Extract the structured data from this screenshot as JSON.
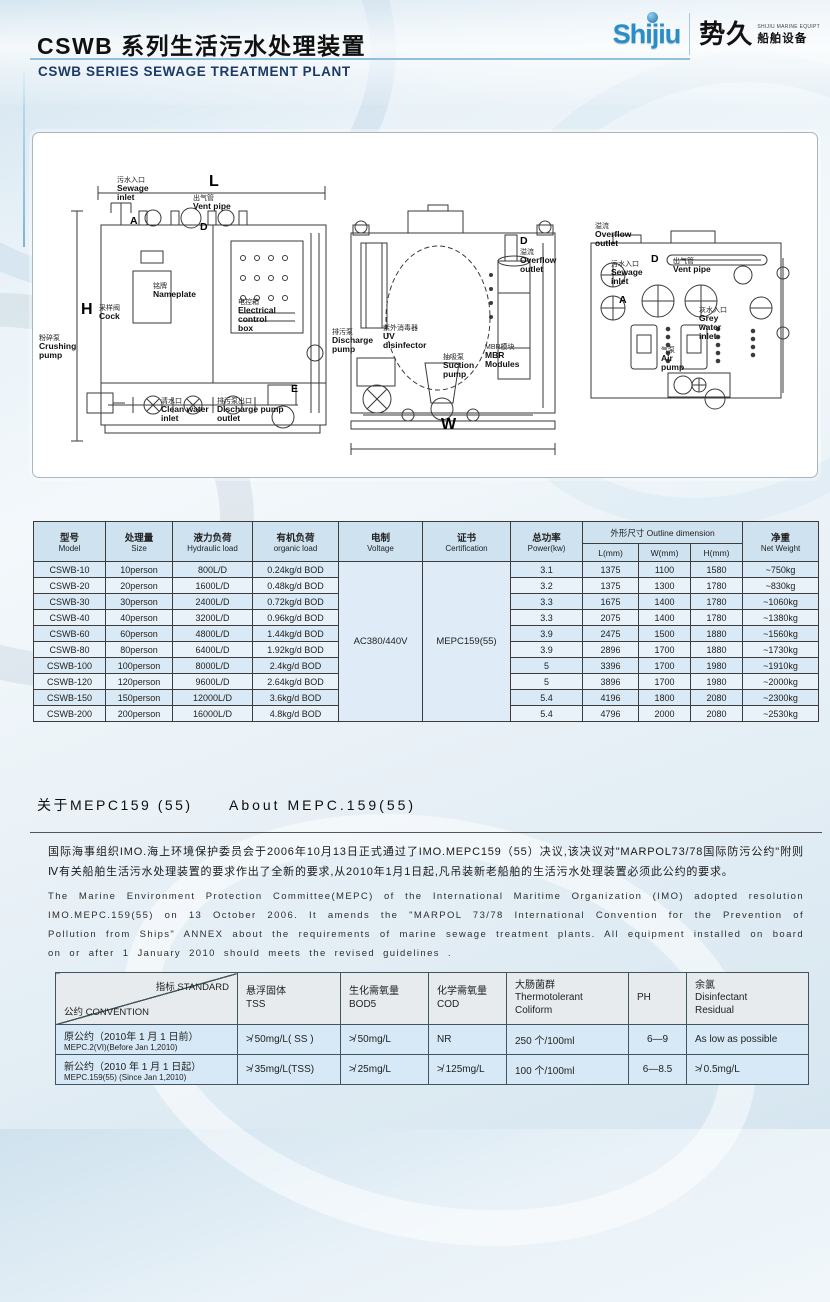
{
  "colors": {
    "brand_blue": "#2b8dc8",
    "title_navy": "#1d3a66",
    "table_header_blue": "#cfe2f0",
    "table_row_blue": "#d9e9f5",
    "table_row_light": "#e9f2f9",
    "std_header_gray": "#e7ebee",
    "std_row_blue": "#d7e9f6"
  },
  "header": {
    "title_cn": "CSWB 系列生活污水处理装置",
    "title_en": "CSWB SERIES  SEWAGE TREATMENT PLANT",
    "logo": {
      "brand": "Shijiu",
      "name_cn": "势久",
      "tagline": "SHIJIU MARINE EQUIPT",
      "sub_cn": "船舶设备"
    }
  },
  "diagram": {
    "labels": {
      "sewage_inlet": {
        "cn": "污水入口",
        "en": "Sewage\ninlet"
      },
      "vent_pipe": {
        "cn": "出气管",
        "en": "Vent  pipe"
      },
      "nameplate": {
        "cn": "铭牌",
        "en": "Nameplate"
      },
      "electrical_box": {
        "cn": "电控箱",
        "en": "Electrical\ncontrol\nbox"
      },
      "cock": {
        "cn": "采样阀",
        "en": "Cock"
      },
      "crushing_pump": {
        "cn": "粉碎泵",
        "en": "Crushing\npump"
      },
      "clean_water_inlet": {
        "cn": "清水口",
        "en": "Clean water\ninlet"
      },
      "discharge_pump_outlet": {
        "cn": "排污泵出口",
        "en": "Discharge pump\noutlet"
      },
      "overflow_outlet_side": {
        "cn": "溢流",
        "en": "Overflow\noutlet"
      },
      "discharge_pump": {
        "cn": "排污泵",
        "en": "Discharge\npump"
      },
      "uv_disinfector": {
        "cn": "紫外消毒器",
        "en": "UV\ndisinfector"
      },
      "suction_pump": {
        "cn": "抽吸泵",
        "en": "Suction\npump"
      },
      "mbr_modules": {
        "cn": "MBR模块",
        "en": "MBR\nModules"
      },
      "overflow_outlet_top": {
        "cn": "溢流",
        "en": "Overflow\noutlet"
      },
      "sewage_inlet_top": {
        "cn": "污水入口",
        "en": "Sewage\ninlet"
      },
      "vent_pipe_top": {
        "cn": "出气管",
        "en": "Vent  pipe"
      },
      "grey_water_inlet": {
        "cn": "灰水入口",
        "en": "Grey\nwater\ninlet"
      },
      "air_pump": {
        "cn": "气泵",
        "en": "Air\npump"
      }
    },
    "markers": {
      "l": "L",
      "h": "H",
      "w": "W",
      "a": "A",
      "d": "D",
      "e": "E"
    }
  },
  "spec_table": {
    "headers": {
      "model_cn": "型号",
      "model_en": "Model",
      "size_cn": "处理量",
      "size_en": "Size",
      "hydraulic_cn": "液力负荷",
      "hydraulic_en": "Hydraulic load",
      "organic_cn": "有机负荷",
      "organic_en": "organic load",
      "voltage_cn": "电制",
      "voltage_en": "Voltage",
      "cert_cn": "证书",
      "cert_en": "Certification",
      "power_cn": "总功率",
      "power_en": "Power(kw)",
      "outline": "外形尺寸  Outline dimension",
      "l": "L(mm)",
      "w": "W(mm)",
      "h": "H(mm)",
      "weight_cn": "净重",
      "weight_en": "Net Weight"
    },
    "voltage": "AC380/440V",
    "certification": "MEPC159(55)",
    "rows": [
      {
        "model": "CSWB-10",
        "size": "10person",
        "hydraulic": "800L/D",
        "organic": "0.24kg/d BOD",
        "power": "3.1",
        "l": "1375",
        "w": "1100",
        "h": "1580",
        "weight": "~750kg"
      },
      {
        "model": "CSWB-20",
        "size": "20person",
        "hydraulic": "1600L/D",
        "organic": "0.48kg/d BOD",
        "power": "3.2",
        "l": "1375",
        "w": "1300",
        "h": "1780",
        "weight": "~830kg"
      },
      {
        "model": "CSWB-30",
        "size": "30person",
        "hydraulic": "2400L/D",
        "organic": "0.72kg/d BOD",
        "power": "3.3",
        "l": "1675",
        "w": "1400",
        "h": "1780",
        "weight": "~1060kg"
      },
      {
        "model": "CSWB-40",
        "size": "40person",
        "hydraulic": "3200L/D",
        "organic": "0.96kg/d BOD",
        "power": "3.3",
        "l": "2075",
        "w": "1400",
        "h": "1780",
        "weight": "~1380kg"
      },
      {
        "model": "CSWB-60",
        "size": "60person",
        "hydraulic": "4800L/D",
        "organic": "1.44kg/d BOD",
        "power": "3.9",
        "l": "2475",
        "w": "1500",
        "h": "1880",
        "weight": "~1560kg"
      },
      {
        "model": "CSWB-80",
        "size": "80person",
        "hydraulic": "6400L/D",
        "organic": "1.92kg/d BOD",
        "power": "3.9",
        "l": "2896",
        "w": "1700",
        "h": "1880",
        "weight": "~1730kg"
      },
      {
        "model": "CSWB-100",
        "size": "100person",
        "hydraulic": "8000L/D",
        "organic": "2.4kg/d BOD",
        "power": "5",
        "l": "3396",
        "w": "1700",
        "h": "1980",
        "weight": "~1910kg"
      },
      {
        "model": "CSWB-120",
        "size": "120person",
        "hydraulic": "9600L/D",
        "organic": "2.64kg/d BOD",
        "power": "5",
        "l": "3896",
        "w": "1700",
        "h": "1980",
        "weight": "~2000kg"
      },
      {
        "model": "CSWB-150",
        "size": "150person",
        "hydraulic": "12000L/D",
        "organic": "3.6kg/d BOD",
        "power": "5.4",
        "l": "4196",
        "w": "1800",
        "h": "2080",
        "weight": "~2300kg"
      },
      {
        "model": "CSWB-200",
        "size": "200person",
        "hydraulic": "16000L/D",
        "organic": "4.8kg/d BOD",
        "power": "5.4",
        "l": "4796",
        "w": "2000",
        "h": "2080",
        "weight": "~2530kg"
      }
    ]
  },
  "mepc_section": {
    "title_cn": "关于MEPC159 (55)",
    "title_en": "About MEPC.159(55)",
    "para_cn": "国际海事组织IMO.海上环境保护委员会于2006年10月13日正式通过了IMO.MEPC159（55）决议,该决议对\"MARPOL73/78国际防污公约\"附则Ⅳ有关船舶生活污水处理装置的要求作出了全新的要求,从2010年1月1日起,凡吊装新老船舶的生活污水处理装置必须此公约的要求。",
    "para_en": "The Marine Environment Protection Committee(MEPC) of the International Maritime Organization (IMO) adopted resolution IMO.MEPC.159(55) on 13 October 2006. It amends the \"MARPOL 73/78 International Convention for the Prevention of Pollution from Ships\" ANNEX about the requirements of marine sewage treatment plants. All equipment installed on board on or after 1 January 2010 should meets the revised guidelines ."
  },
  "standards_table": {
    "corner": {
      "top": "指标 STANDARD",
      "bottom": "公约 CONVENTION"
    },
    "headers": [
      "悬浮固体\nTSS",
      "生化需氧量\nBOD5",
      "化学需氧量\nCOD",
      "大肠菌群\nThermotolerant\nColiform",
      "PH",
      "余氯\nDisinfectant\nResidual"
    ],
    "rows": [
      {
        "conv_cn": "原公约（2010年 1 月 1 日前）",
        "conv_en": "MEPC.2(VI)(Before Jan 1,2010)",
        "tss": "≯ 50mg/L( SS )",
        "bod5": "≯ 50mg/L",
        "cod": "NR",
        "coliform": "250 个/100ml",
        "ph": "6—9",
        "residual": "As low as possible"
      },
      {
        "conv_cn": "新公约（2010 年 1 月 1 日起）",
        "conv_en": "MEPC.159(55) (Since Jan 1,2010)",
        "tss": "≯ 35mg/L(TSS)",
        "bod5": "≯ 25mg/L",
        "cod": "≯ 125mg/L",
        "coliform": "100 个/100ml",
        "ph": "6—8.5",
        "residual": "≯ 0.5mg/L"
      }
    ]
  }
}
